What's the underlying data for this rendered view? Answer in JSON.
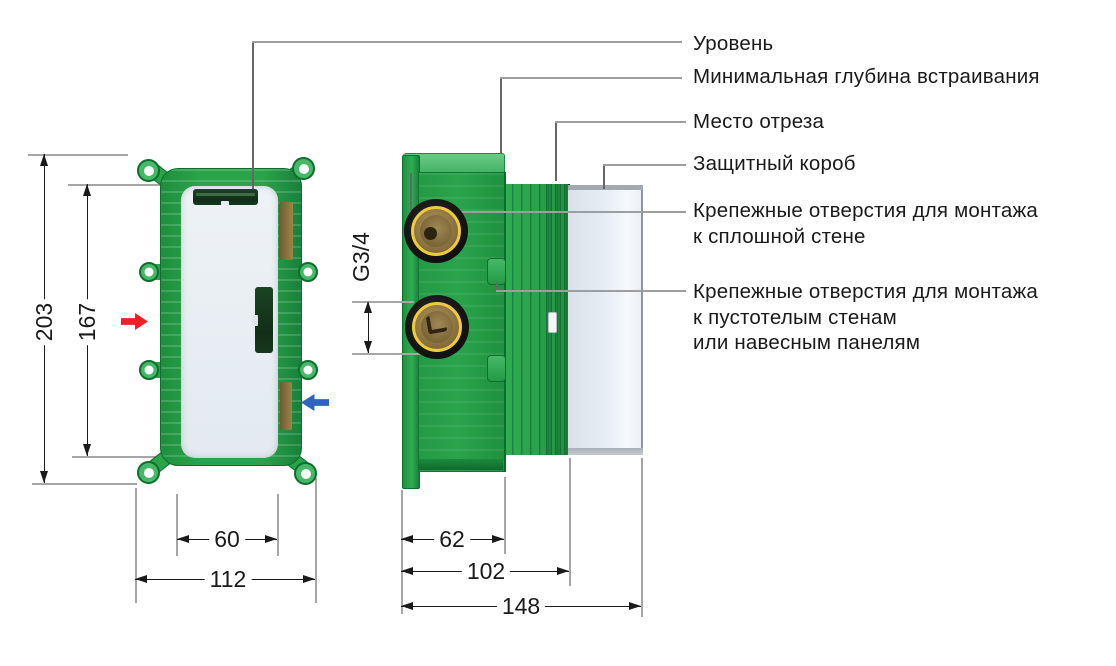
{
  "callouts": {
    "level": "Уровень",
    "min_depth": "Минимальная глубина встраивания",
    "cut_place": "Место отреза",
    "protective_box": "Защитный короб",
    "solid_wall_1": "Крепежные отверстия для монтажа",
    "solid_wall_2": "к сплошной стене",
    "hollow_wall_1": "Крепежные отверстия для монтажа",
    "hollow_wall_2": "к пустотелым стенам",
    "hollow_wall_3": "или навесным панелям"
  },
  "dimensions": {
    "front_overall_height_mm": "203",
    "front_mounting_height_mm": "167",
    "front_inner_width_mm": "60",
    "front_overall_width_mm": "112",
    "side_body_depth_mm": "62",
    "side_min_embed_depth_mm": "102",
    "side_overall_depth_mm": "148",
    "connection_thread": "G3/4"
  },
  "colors": {
    "body_green": "#2aa44b",
    "green_dark": "#0e6f2c",
    "green_light": "#45b968",
    "brass_ring": "#eecb3d",
    "hot_arrow": "#ec2227",
    "cold_arrow": "#2d64bc",
    "dimension_line": "#1a1a1a",
    "extension_line": "#a6a6a6",
    "leader_line": "#9e9e9e"
  }
}
